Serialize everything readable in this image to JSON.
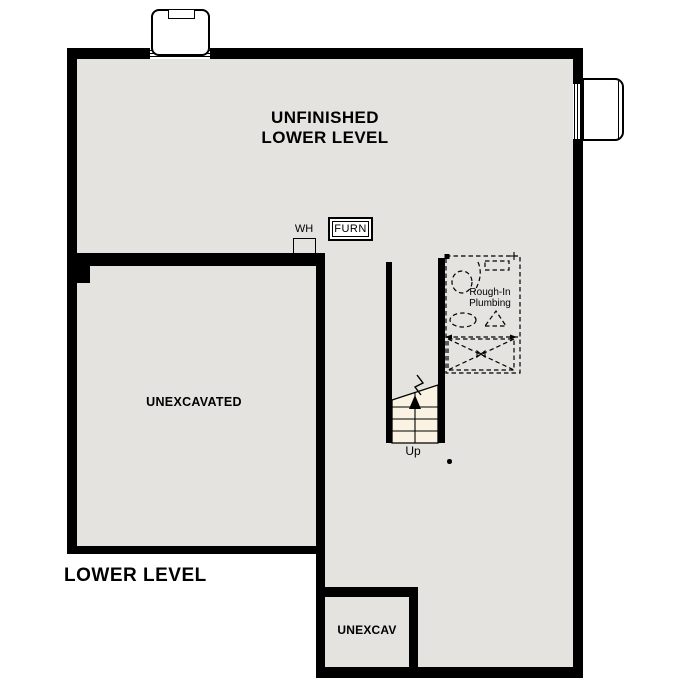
{
  "plan": {
    "title": "LOWER LEVEL",
    "rooms": {
      "unfinished": "UNFINISHED\nLOWER LEVEL",
      "unexcavated": "UNEXCAVATED",
      "unexcav": "UNEXCAV"
    },
    "fixtures": {
      "water_heater": "WH",
      "furnace": "FURN",
      "rough_in_plumbing": "Rough-In\nPlumbing"
    },
    "stairs": {
      "direction": "Up"
    },
    "colors": {
      "wall": "#000000",
      "floor": "#e4e3e0",
      "stairs_fill": "#faf3e3",
      "background": "#ffffff"
    }
  }
}
